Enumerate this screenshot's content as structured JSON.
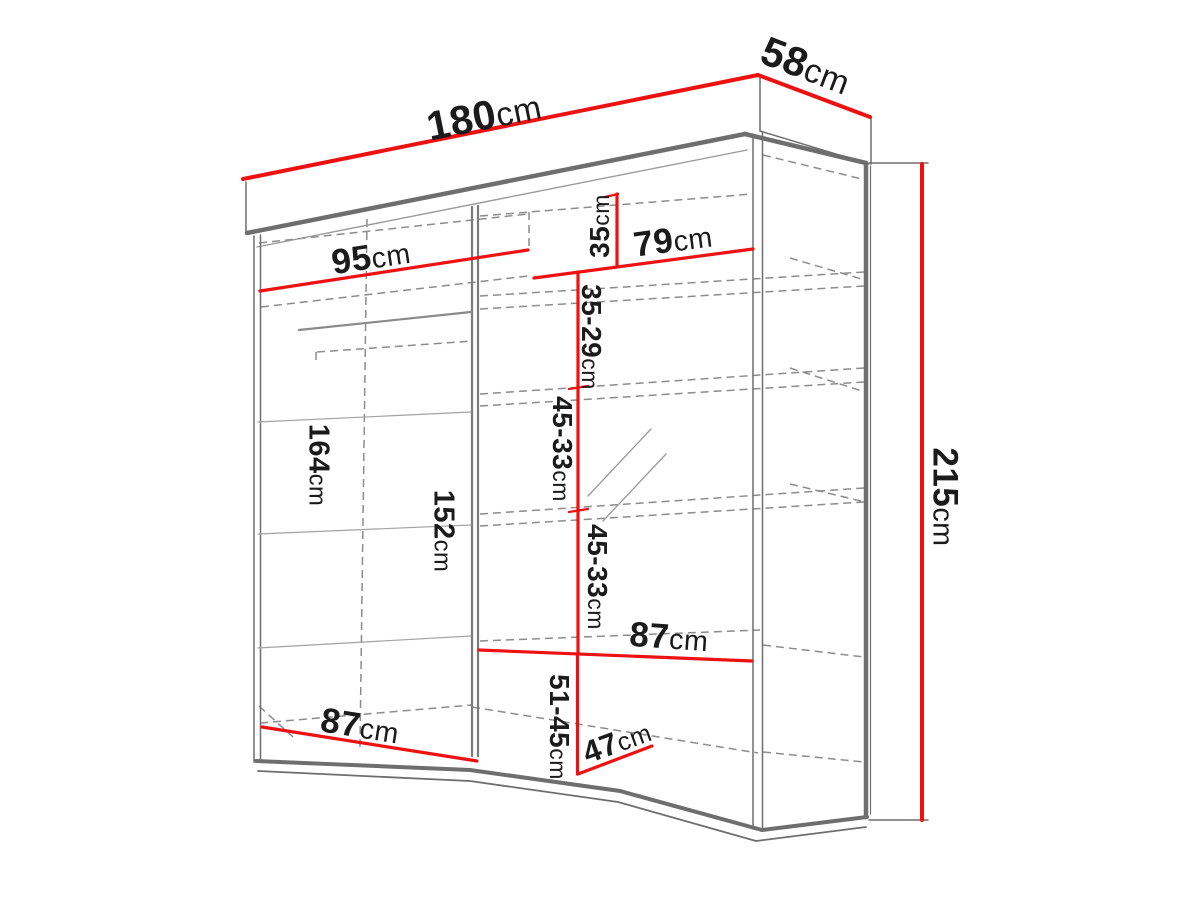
{
  "diagram": {
    "title": "wardrobe-dimension-drawing",
    "unit": "cm",
    "colors": {
      "dimension_line": "#ee1111",
      "structure": "#6e6e6e",
      "dashed": "#8c8c8c",
      "text": "#1b1b1b",
      "background": "#ffffff"
    },
    "dimensions": {
      "total_width": {
        "value": "180",
        "unit": "cm"
      },
      "total_depth": {
        "value": "58",
        "unit": "cm"
      },
      "total_height": {
        "value": "215",
        "unit": "cm"
      },
      "left_width": {
        "value": "95",
        "unit": "cm"
      },
      "right_width": {
        "value": "79",
        "unit": "cm"
      },
      "top_shelf": {
        "value": "35",
        "unit": "cm"
      },
      "shelf_35_29": {
        "value": "35-29",
        "unit": "cm"
      },
      "height_164": {
        "value": "164",
        "unit": "cm"
      },
      "height_152": {
        "value": "152",
        "unit": "cm"
      },
      "shelf_45_33_a": {
        "value": "45-33",
        "unit": "cm"
      },
      "shelf_45_33_b": {
        "value": "45-33",
        "unit": "cm"
      },
      "width_87_right": {
        "value": "87",
        "unit": "cm"
      },
      "shelf_51_45": {
        "value": "51-45",
        "unit": "cm"
      },
      "depth_47": {
        "value": "47",
        "unit": "cm"
      },
      "width_87_left": {
        "value": "87",
        "unit": "cm"
      }
    }
  }
}
